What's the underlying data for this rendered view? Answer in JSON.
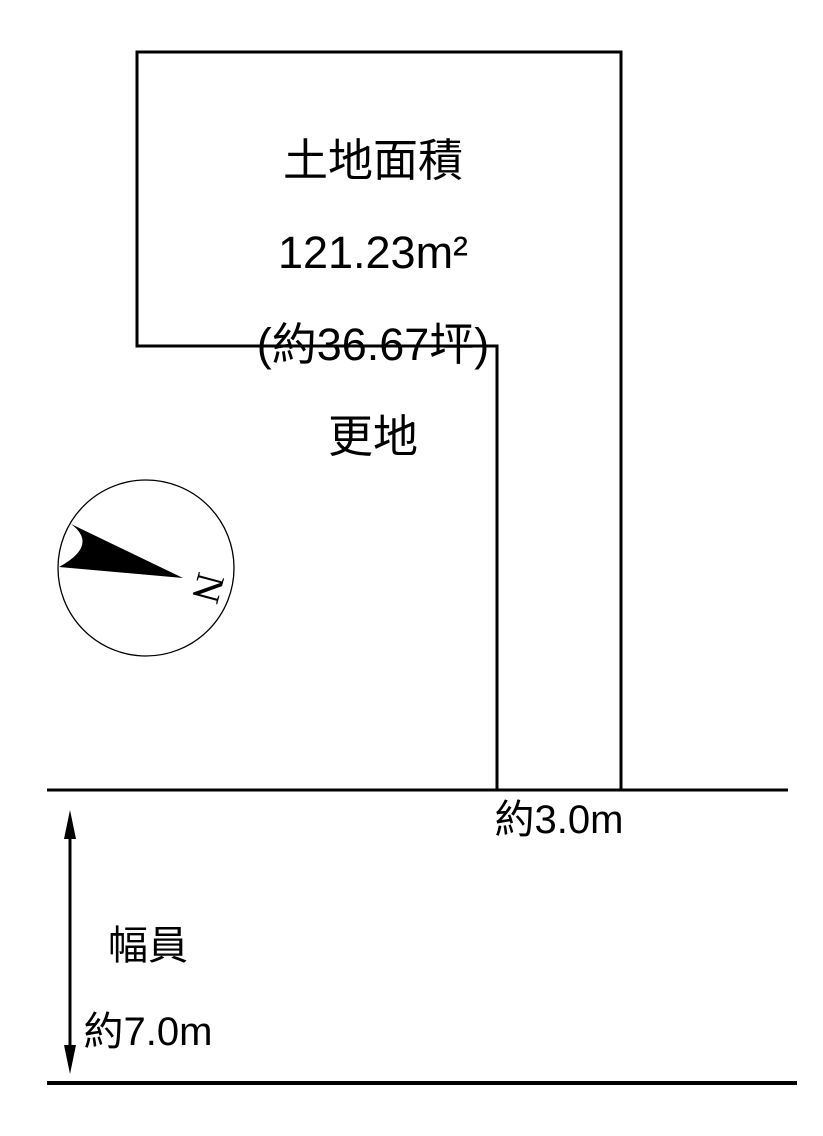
{
  "page": {
    "background_color": "#ffffff",
    "line_color": "#000000"
  },
  "land": {
    "title": "土地面積",
    "area_sqm": "121.23m²",
    "area_tsubo": "(約36.67坪)",
    "status": "更地"
  },
  "road": {
    "frontage_label": "約3.0m",
    "width_label": {
      "line1": "幅員",
      "line2": "約7.0m"
    }
  },
  "compass": {
    "north": "N"
  }
}
